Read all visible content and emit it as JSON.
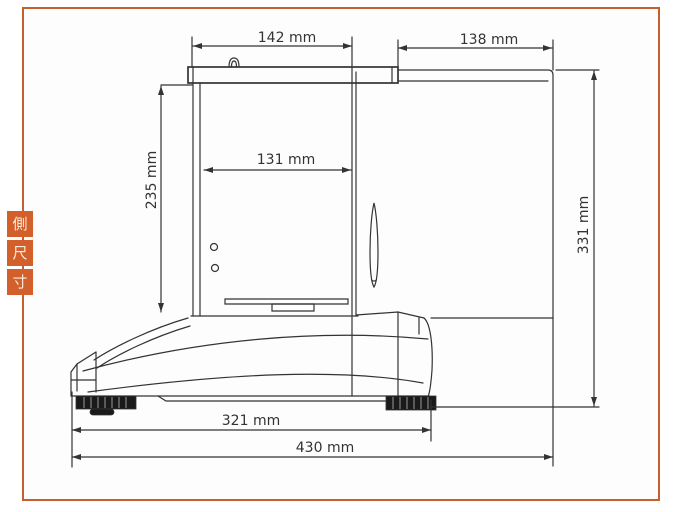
{
  "colors": {
    "frame_border": "#c2612e",
    "tab_background": "#d35f2a",
    "tab_text": "#faeadd",
    "ink": "#333333",
    "foot_fill": "#1a1a1a"
  },
  "side_tabs": {
    "items": [
      {
        "label": "側"
      },
      {
        "label": "尺"
      },
      {
        "label": "寸"
      }
    ]
  },
  "diagram": {
    "dimensions": {
      "top_width": "142 mm",
      "door_open_depth": "138 mm",
      "chamber_inner_width": "131 mm",
      "chamber_height": "235 mm",
      "overall_height": "331 mm",
      "base_depth": "321 mm",
      "overall_depth_door_open": "430 mm"
    }
  }
}
